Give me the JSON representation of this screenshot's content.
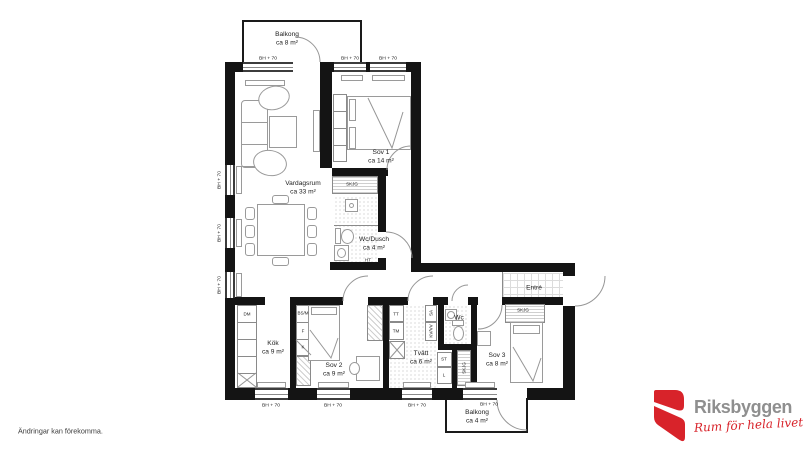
{
  "floorplan": {
    "rooms": [
      {
        "name": "Balkong",
        "area": "ca 8 m²"
      },
      {
        "name": "Vardagsrum",
        "area": "ca 33 m²"
      },
      {
        "name": "Sov 1",
        "area": "ca 14 m²"
      },
      {
        "name": "Wc/Dusch",
        "area": "ca 4 m²"
      },
      {
        "name": "Entré",
        "area": ""
      },
      {
        "name": "Kök",
        "area": "ca 9 m²"
      },
      {
        "name": "Sov 2",
        "area": "ca 9 m²"
      },
      {
        "name": "Tvätt",
        "area": "ca 6 m²"
      },
      {
        "name": "Wc",
        "area": ""
      },
      {
        "name": "Sov 3",
        "area": "ca 8 m²"
      },
      {
        "name": "Balkong",
        "area": "ca 4 m²"
      }
    ],
    "window_label": "BH + 70",
    "fixtures": {
      "dm": "DM",
      "bs_m": "BS/M",
      "f": "F",
      "k": "K",
      "tt": "TT",
      "tm": "TM",
      "st": "ST",
      "l": "L",
      "sa": "SA",
      "kv_vv": "KV/VV",
      "skjg": "SKJG",
      "ht": "HT"
    }
  },
  "footer": {
    "disclaimer": "Ändringar kan förekomma."
  },
  "logo": {
    "brand": "Riksbyggen",
    "tagline": "Rum för hela livet",
    "brand_color": "#8f8f8f",
    "mark_color": "#d8232a"
  }
}
